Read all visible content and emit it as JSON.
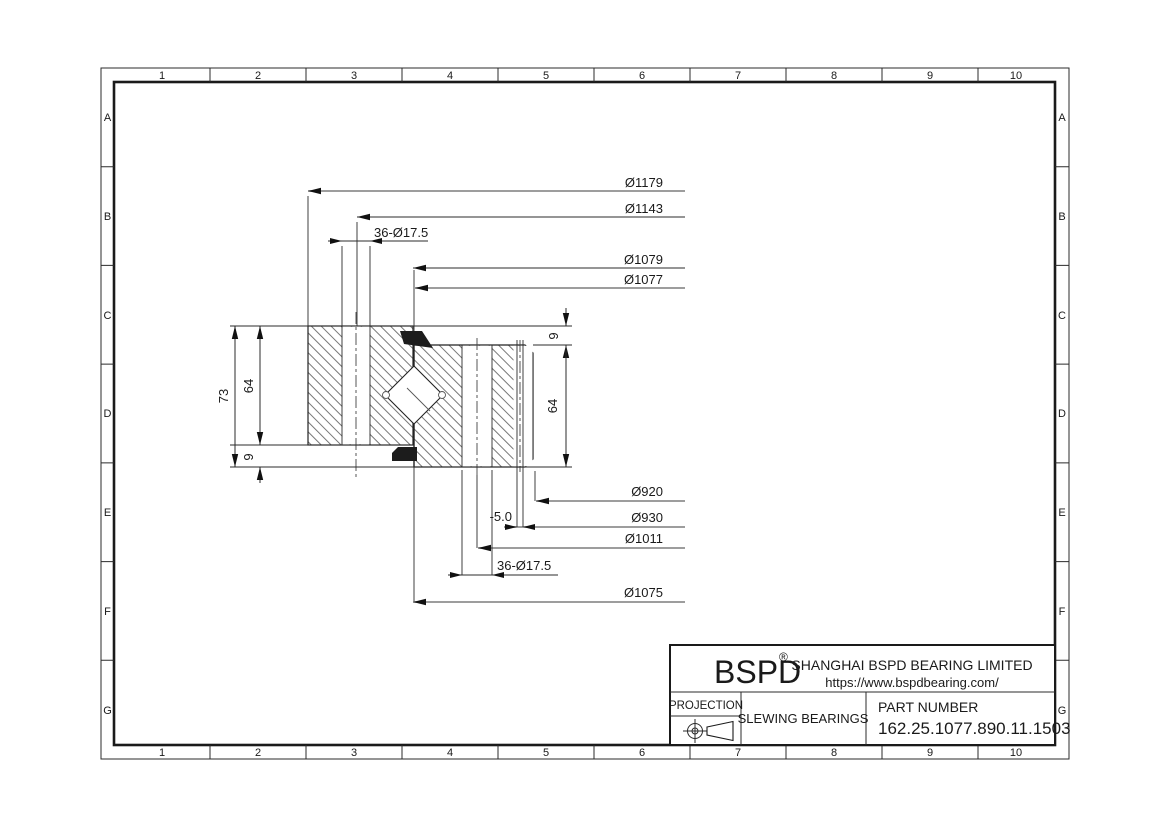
{
  "grid": {
    "columns": [
      "1",
      "2",
      "3",
      "4",
      "5",
      "6",
      "7",
      "8",
      "9",
      "10"
    ],
    "rows": [
      "A",
      "B",
      "C",
      "D",
      "E",
      "F",
      "G"
    ]
  },
  "dimensions": {
    "top": [
      "Ø1179",
      "Ø1143",
      "36-Ø17.5",
      "Ø1079",
      "Ø1077"
    ],
    "left": [
      "73",
      "64",
      "9"
    ],
    "right": [
      "9",
      "64"
    ],
    "bottom": [
      "Ø920",
      "-5.0",
      "Ø930",
      "Ø1011",
      "36-Ø17.5",
      "Ø1075"
    ]
  },
  "title_block": {
    "brand": "BSPD",
    "registered_mark": "®",
    "company": "SHANGHAI BSPD BEARING LIMITED",
    "website": "https://www.bspdbearing.com/",
    "projection_label": "PROJECTION",
    "product_type": "SLEWING BEARINGS",
    "part_number_label": "PART  NUMBER",
    "part_number": "162.25.1077.890.11.1503"
  }
}
